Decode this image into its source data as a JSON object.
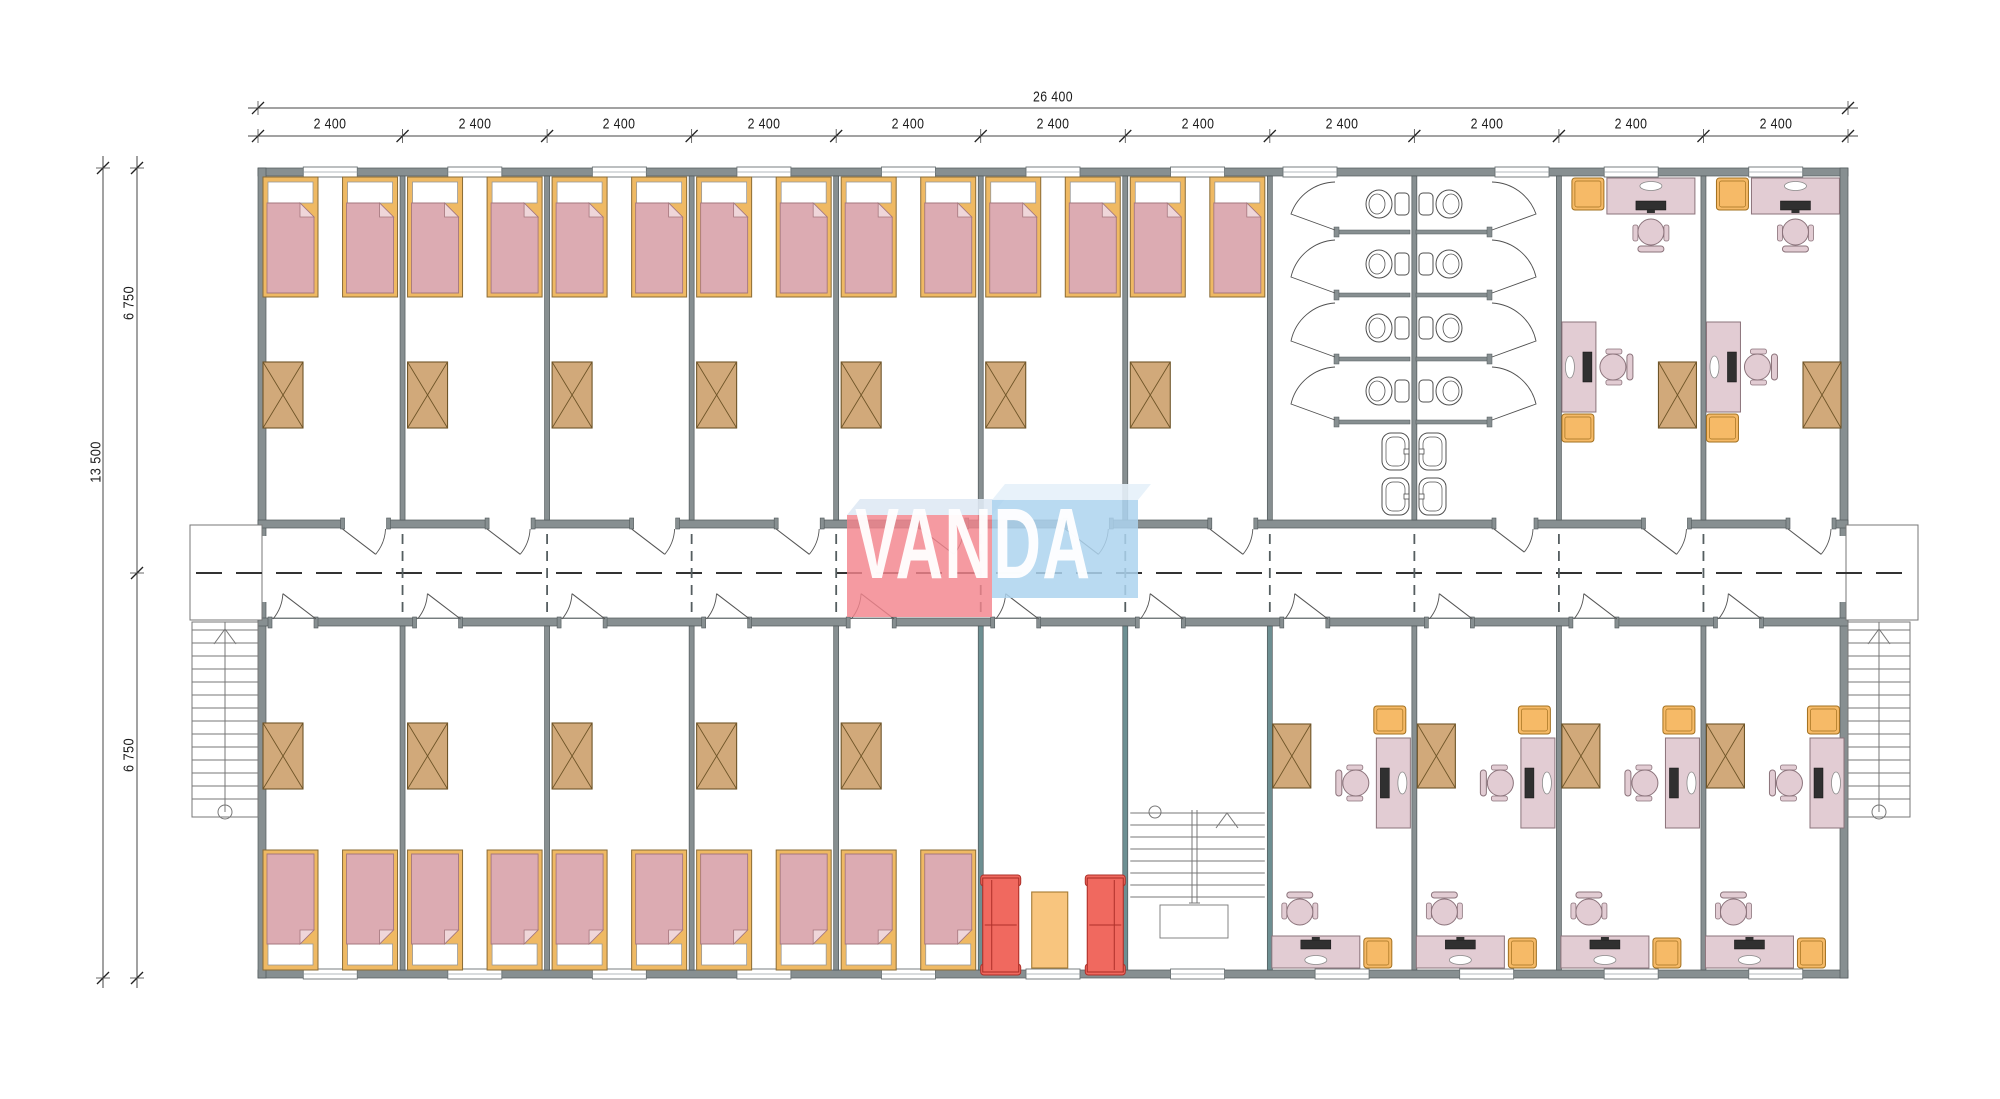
{
  "dimensions": {
    "total_width_label": "26 400",
    "bay_width_label": "2 400",
    "bay_count": 11,
    "total_height_label": "13 500",
    "half_height_label_top": "6 750",
    "half_height_label_bottom": "6 750"
  },
  "watermark": {
    "text": "VANDA"
  },
  "plan": {
    "bays": 11,
    "top_zones": [
      {
        "type": "bedroom",
        "count": 7
      },
      {
        "type": "bathroom",
        "count": 2
      },
      {
        "type": "office",
        "count": 2
      }
    ],
    "bottom_zones": [
      {
        "type": "bedroom",
        "count": 5
      },
      {
        "type": "lounge",
        "count": 1
      },
      {
        "type": "staircase",
        "count": 1
      },
      {
        "type": "office",
        "count": 4
      }
    ],
    "fixtures": {
      "beds": 24,
      "wardrobes": 18,
      "toilet_stalls": 8,
      "sinks": 4,
      "desks": 12,
      "office_chairs": 12,
      "sofas": 2,
      "coffee_tables": 1,
      "external_stairs": 2,
      "internal_stairs": 1
    }
  },
  "colors": {
    "wall": "#878f91",
    "wall_edge": "#50585a",
    "teal_wall": "#6d8f92",
    "window_frame": "#6a7274",
    "bed_frame": "#efb963",
    "bed_frame_edge": "#8a6b35",
    "bed_blanket": "#dcabb2",
    "bed_blanket_edge": "#a5777e",
    "bed_fold": "#efd6d9",
    "pillow": "#ffffff",
    "wardrobe": "#d1a97a",
    "wardrobe_edge": "#6f5528",
    "desk": "#e2ccd3",
    "desk_edge": "#8b737b",
    "monitor": "#303030",
    "cabinet": "#f6ba67",
    "cabinet_edge": "#a2701f",
    "sofa": "#f0695f",
    "sofa_edge": "#ae3029",
    "table": "#f8c57e",
    "table_edge": "#a57a33",
    "fixture_line": "#4f4f4f",
    "stair_line": "#777777",
    "door_line": "#555555",
    "dash_line": "#333333",
    "dim_line": "#444444",
    "dim_text": "#1c1c1c",
    "watermark_red": "rgba(243,132,140,0.82)",
    "watermark_red_top": "rgba(223,233,244,0.9)",
    "watermark_blue": "rgba(173,211,239,0.85)",
    "watermark_blue_top": "rgba(230,241,250,0.9)",
    "watermark_text": "rgba(255,255,255,0.95)"
  }
}
